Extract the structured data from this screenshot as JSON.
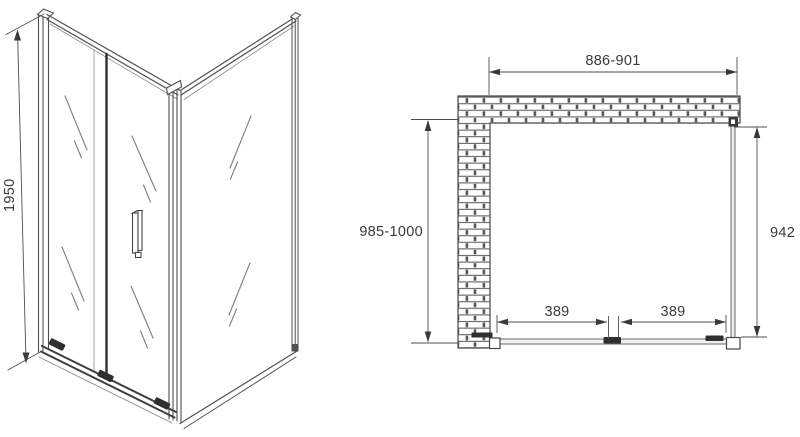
{
  "diagram": {
    "type": "technical-drawing",
    "subject": "corner shower enclosure with sliding door - isometric view and top plan view",
    "views": {
      "isometric": {
        "dimensions": {
          "height": "1950"
        }
      },
      "plan": {
        "dimensions": {
          "opening_width": "886-901",
          "depth": "985-1000",
          "side_panel": "942",
          "door_section_left": "389",
          "door_section_right": "389"
        }
      }
    },
    "colors": {
      "line": "#4f4f4f",
      "dark": "#2f2f2f",
      "text": "#3a3a3a",
      "background": "#ffffff"
    }
  }
}
